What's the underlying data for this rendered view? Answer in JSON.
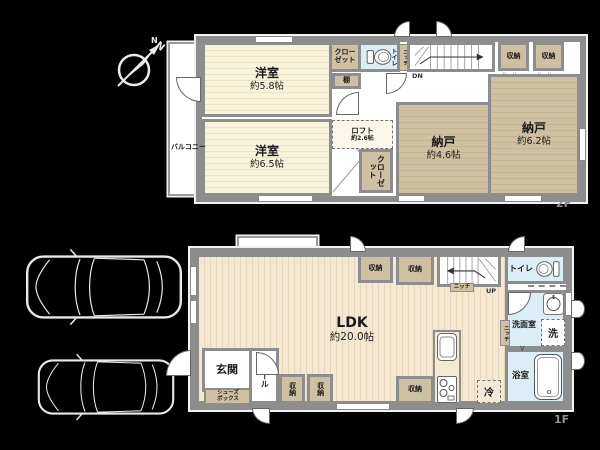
{
  "compass": {
    "north_label": "N"
  },
  "colors": {
    "wall": "#8d8d8d",
    "cream": "#f8f3db",
    "creamline": "#eae3c6",
    "wood": "#f4e8d3",
    "woodline": "#e6d6ba",
    "tan": "#cec0a2",
    "tanline": "#c3b391",
    "wet": "#dcedf5"
  },
  "f2": {
    "floor_label": "2F",
    "balcony_label": "バルコニー",
    "yoshitsu58": {
      "name": "洋室",
      "size": "約5.8帖"
    },
    "closet_top_line1": "クロー",
    "closet_top_line2": "ゼット",
    "shelf_label": "棚",
    "toilet_label": "トイレ",
    "niche_label": "ニッチ",
    "stairs_down_label": "DN",
    "storage1_label": "収納",
    "storage2_label": "収納",
    "nando46": {
      "name": "納戸",
      "size": "約4.6帖"
    },
    "nando62": {
      "name": "納戸",
      "size": "約6.2帖"
    },
    "yoshitsu65": {
      "name": "洋室",
      "size": "約6.5帖"
    },
    "loft": {
      "name": "ロフト",
      "size": "約2.6帖"
    },
    "closet_bottom_label": "クローゼット"
  },
  "f1": {
    "floor_label": "1F",
    "bay_window_label": "出窓",
    "ldk": {
      "name": "LDK",
      "size": "約20.0帖"
    },
    "storage_top1_label": "収納",
    "storage_top2_label": "収納",
    "stairs_up_label": "UP",
    "stairs_niche_label": "ニッチ",
    "toilet_label": "トイレ",
    "washroom_label": "洗面室",
    "laundry_label": "洗",
    "wall_niche_label": "ニッチ",
    "bathroom_label": "浴室",
    "fridge_label": "冷",
    "storage_bottom_label": "収納",
    "genkan_label": "玄関",
    "shoes_box_line1": "シューズ",
    "shoes_box_line2": "ボックス",
    "hall_label": "ホール",
    "storage_v1_label": "収納",
    "storage_v2_label": "収納"
  }
}
